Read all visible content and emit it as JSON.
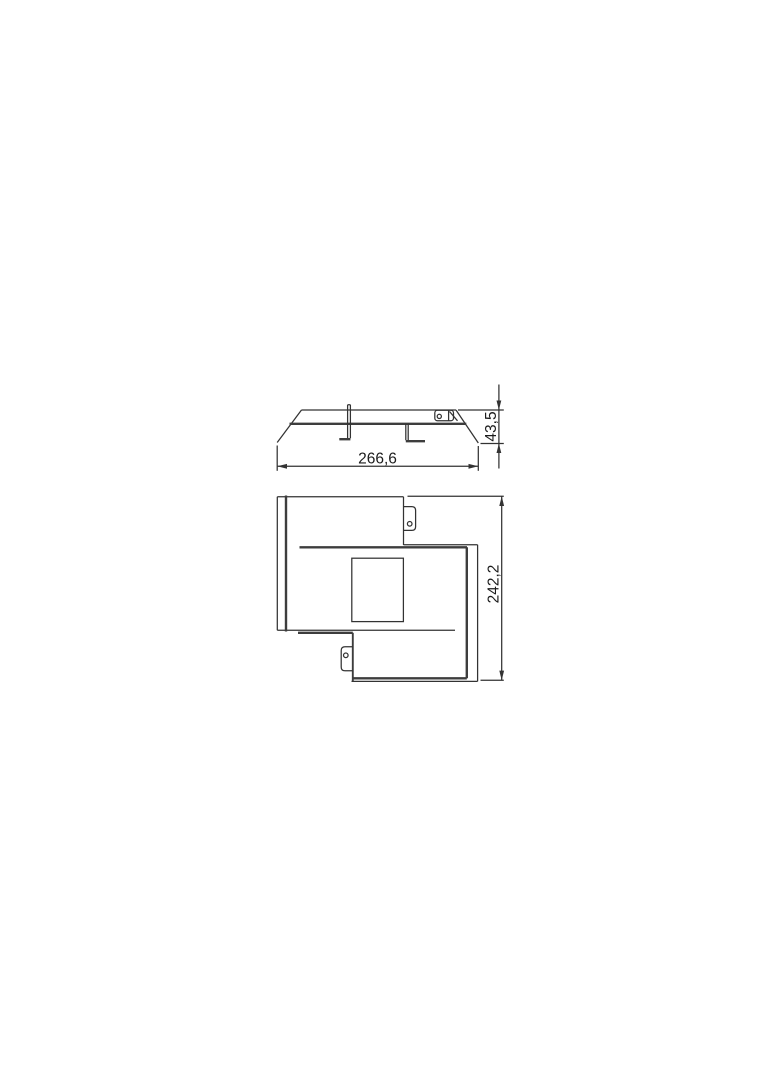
{
  "page": {
    "background_color": "#ffffff"
  },
  "drawing": {
    "kind": "dimensioned technical line drawing, two orthographic views",
    "line_color": "#333333",
    "text_color": "#1c1c1c",
    "views": {
      "side_elevation": {
        "name": "side-elevation-view",
        "width_dim": "266,6",
        "height_dim": "43,5"
      },
      "plan": {
        "name": "plan-view",
        "height_dim": "242,2"
      }
    }
  }
}
